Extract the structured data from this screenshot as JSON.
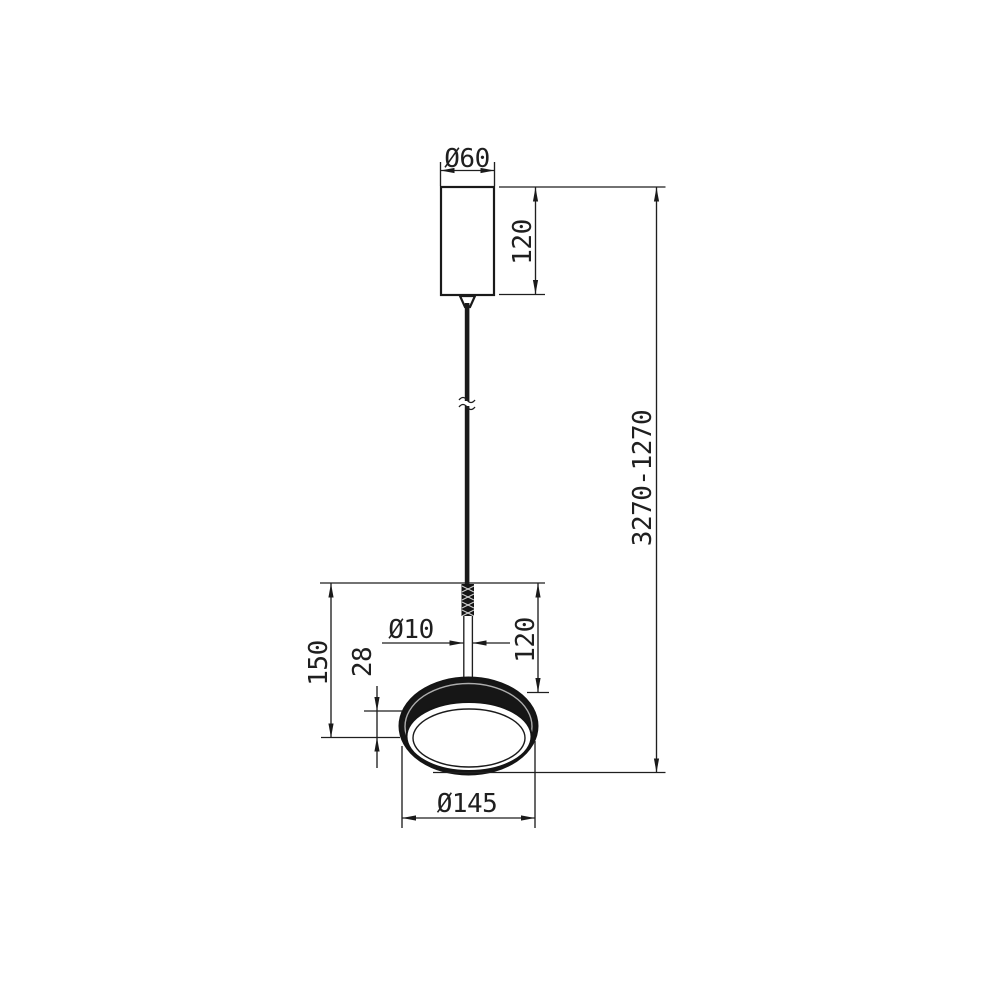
{
  "drawing": {
    "title": "Pendant lamp dimensional drawing",
    "background_color": "#ffffff",
    "line_color": "#1a1a1a",
    "dimensions": {
      "canopy_diameter": "Ø60",
      "canopy_height": "120",
      "suspension_range": "3270-1270",
      "fixture_height": "150",
      "rim_height": "28",
      "stem_diameter": "Ø10",
      "shade_top_height": "120",
      "shade_diameter": "Ø145"
    }
  }
}
